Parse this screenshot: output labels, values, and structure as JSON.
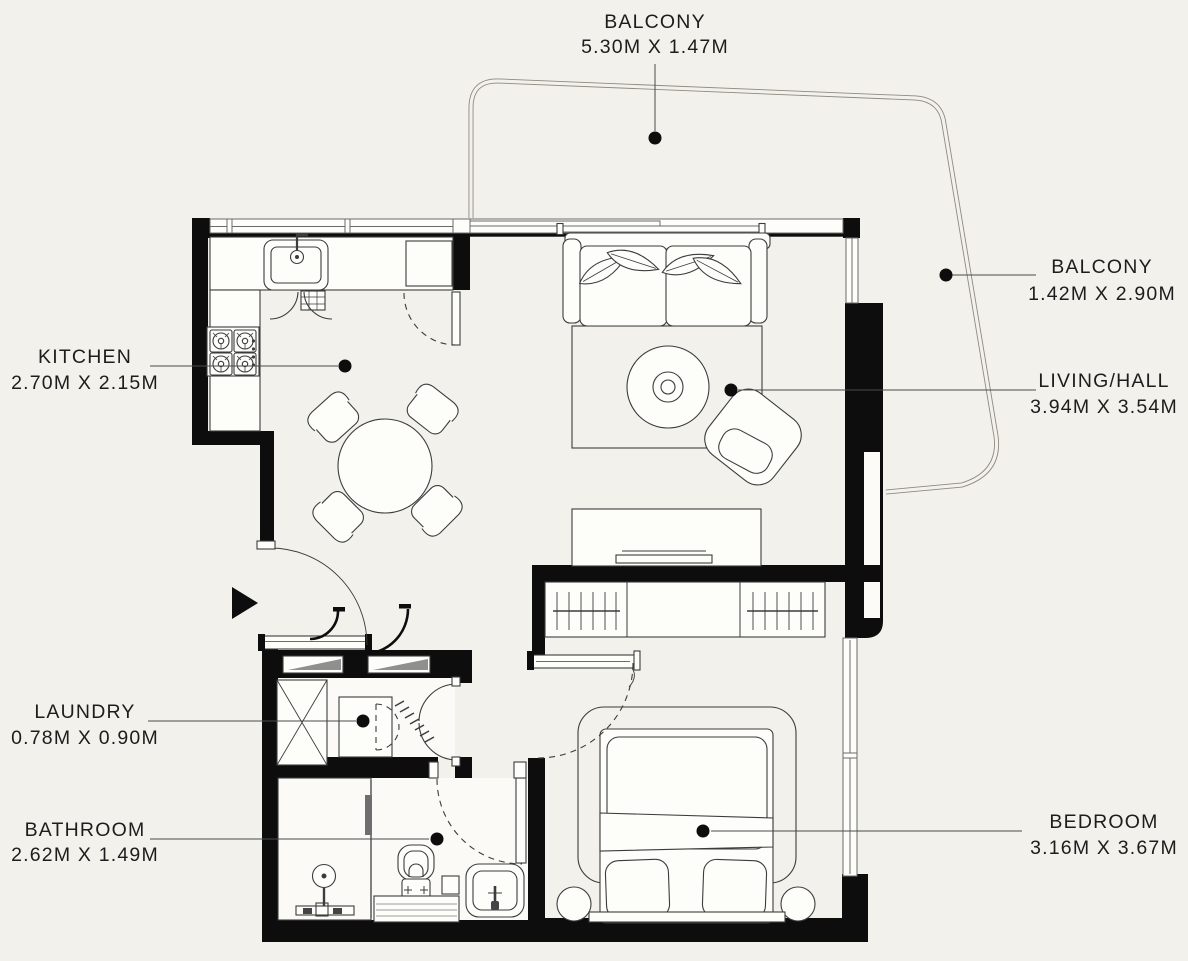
{
  "title": "Apartment Floor Plan",
  "colors": {
    "background": "#f3f1ec",
    "wall": "#0d0d0d",
    "line": "#3c3c3c",
    "paper": "#fdfdfa",
    "windowline": "#6b6b6b",
    "leader": "#4a4a4a",
    "text": "#1d1d1d",
    "gray": "#8f8f8f",
    "floor": "#fbfaf6"
  },
  "rooms": [
    {
      "name": "BALCONY",
      "dims": "5.30M X 1.47M"
    },
    {
      "name": "BALCONY",
      "dims": "1.42M X 2.90M"
    },
    {
      "name": "LIVING/HALL",
      "dims": "3.94M X 3.54M"
    },
    {
      "name": "KITCHEN",
      "dims": "2.70M X 2.15M"
    },
    {
      "name": "LAUNDRY",
      "dims": "0.78M X 0.90M"
    },
    {
      "name": "BATHROOM",
      "dims": "2.62M X 1.49M"
    },
    {
      "name": "BEDROOM",
      "dims": "3.16M X 3.67M"
    }
  ]
}
